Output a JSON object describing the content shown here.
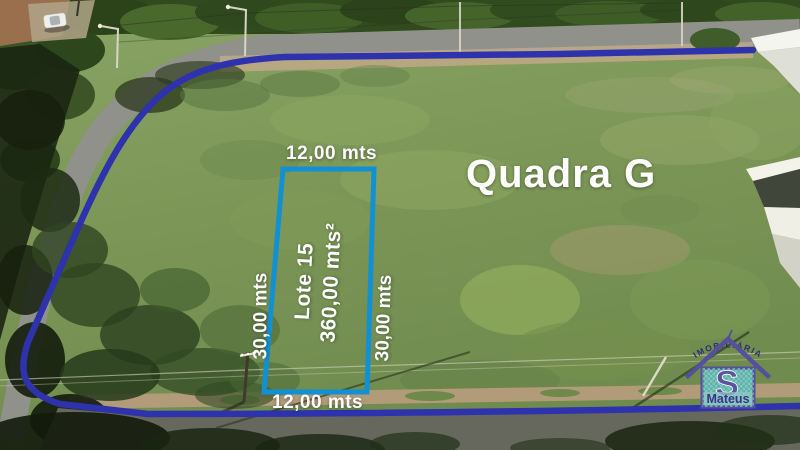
{
  "annotations": {
    "block_label": "Quadra G",
    "lot_label": "Lote 15",
    "lot_area": "360,00 mts²",
    "width_top": "12,00 mts",
    "width_bottom": "12,00 mts",
    "depth_left": "30,00 mts",
    "depth_right": "30,00 mts"
  },
  "logo": {
    "arc_text": "IMOBILIÁRIA",
    "initial": "S",
    "name": "Mateus"
  },
  "colors": {
    "boundary_line": "#2e32ad",
    "lot_outline": "#1191d4",
    "annotation_text": "#ffffff",
    "logo_outline_purple": "#55509c",
    "logo_body_teal": "#5eb2a9",
    "logo_initial_color": "#5a549f",
    "logo_name_color": "#3a3488"
  }
}
